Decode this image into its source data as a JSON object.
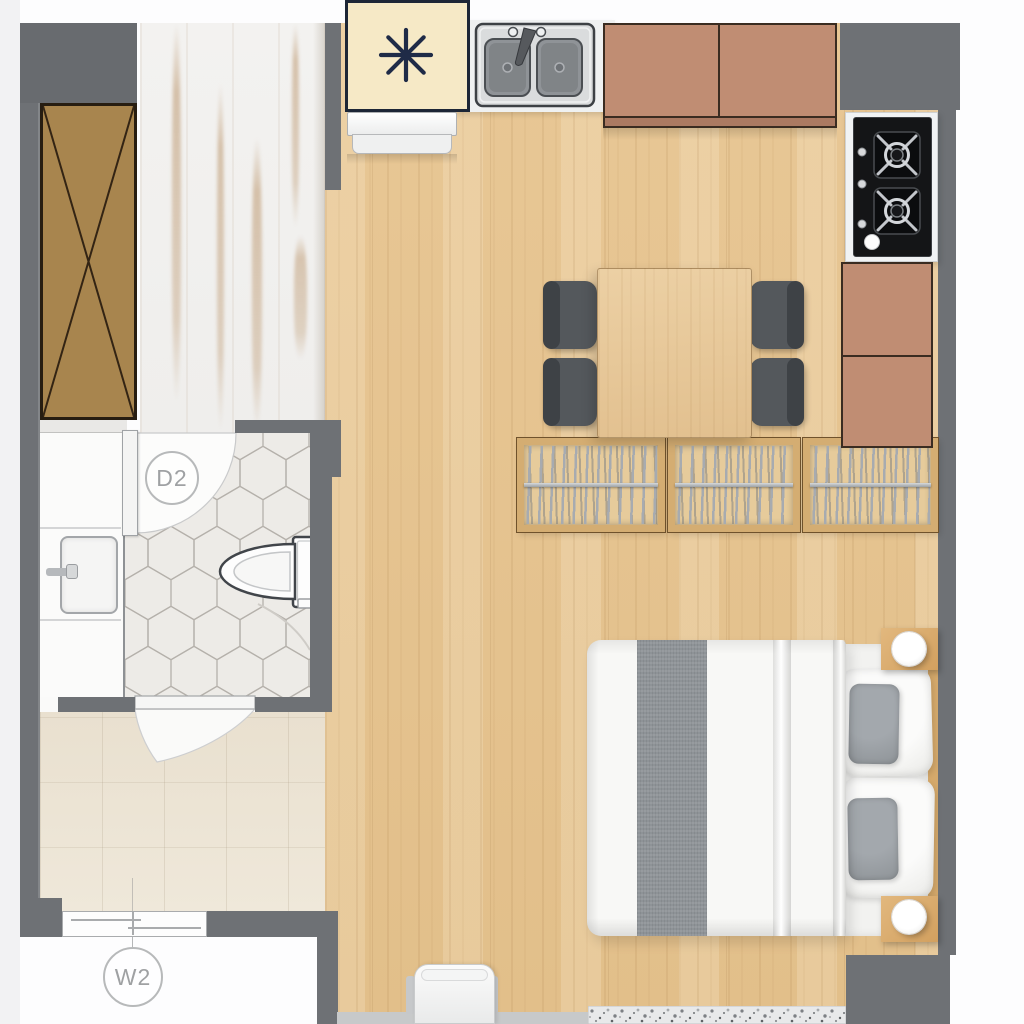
{
  "plan": {
    "type": "studio-apartment-floor-plan",
    "labels": {
      "bathroom_door_tag": "D2",
      "balcony_window_tag": "W2"
    },
    "rooms": {
      "entry_hallway": {
        "floor": "white-painted-plank",
        "furniture": [
          "wardrobe-with-x-symbol"
        ]
      },
      "kitchen": {
        "floor": "light-oak-wood",
        "fixtures": [
          "refrigerator",
          "double-basin-sink",
          "upper-cabinets-2-door",
          "two-burner-gas-cooktop",
          "base-cabinets-2-door"
        ]
      },
      "dining_area": {
        "furniture": [
          "square-wood-table",
          "dark-gray-chairs-x4",
          "slatted-storage-racks-x3"
        ]
      },
      "sleeping_area": {
        "furniture": [
          "double-bed-white-duvet-gray-stripe",
          "white-pillows-x2",
          "gray-pillows-x2",
          "nightstands-x2",
          "round-lamps-x2"
        ]
      },
      "bathroom": {
        "floor": "hexagonal-tile",
        "fixtures": [
          "vanity-with-sink",
          "toilet",
          "swing-door-d2"
        ]
      },
      "balcony_laundry": {
        "floor": "beige-tile",
        "fixtures": [
          "swing-door",
          "sliding-window-w2"
        ]
      },
      "misc": [
        "white-chair-bottom-edge",
        "terrazzo-mat-strip"
      ]
    },
    "colors": {
      "wall": "#6e7175",
      "wood": "#e8c795",
      "wardrobe": "#a8854e",
      "cabinet": "#c08d73",
      "fridge": "#f6e9c6",
      "fridge_symbol": "#1f2b47",
      "chair": "#54585c",
      "table": "#e2c08f",
      "duvet_stripe": "#8e9397",
      "tile_beige": "#efe8da",
      "label_gray": "#9fa1a3",
      "rack_wood": "#e6cb9b",
      "rod_silver": "#a7abb0"
    }
  }
}
